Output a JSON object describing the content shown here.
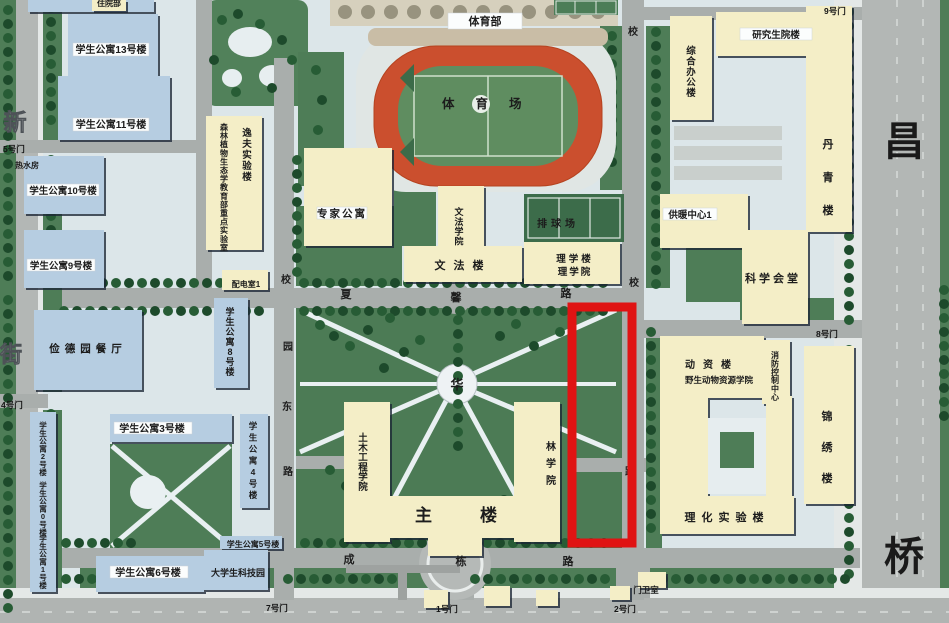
{
  "colors": {
    "highlight": "#e01313",
    "track": "#cb4f2e",
    "field": "#5f8d60",
    "lawn": "#4e7d57",
    "dorm_building": "#b6cde1",
    "academic_building": "#f4eec7",
    "road": "#a9aeac"
  },
  "buildings": {
    "hospital": "住院部",
    "dorm13": "学生公寓13号楼",
    "dorm11": "学生公寓11号楼",
    "dorm10": "学生公寓10号楼",
    "dorm9": "学生公寓9号楼",
    "canteen": "俭德园餐厅",
    "dorm8": "学生公寓8号楼",
    "dorm3": "学生公寓3号楼",
    "dorm4": "学生公寓4号楼",
    "dorm2": "学生公寓2号楼",
    "dorm0": "学生公寓0号楼",
    "dorm1": "学生公寓1号楼",
    "dorm6": "学生公寓6号楼",
    "dorm5": "学生公寓5号楼",
    "techpark": "大学生科技园",
    "hotwater": "热水房",
    "forest_lab": "森林植物生态学教育部重点实验室",
    "yifu": "逸夫实验楼",
    "peidian": "配电室1",
    "expert": "专家公寓",
    "wenfa_college": "文法学院",
    "wenfa_lou": "文法楼",
    "tiyubu": "体育部",
    "stadium": "体育场",
    "volleyball": "排球场",
    "lixuelou": "理学楼",
    "lixueyuan": "理学院",
    "grad": "研究生院楼",
    "zonghe": "综合办公楼",
    "danqing": "丹青楼",
    "gongnuan": "供暖中心1",
    "kexue": "科学会堂",
    "dongzi": "动资楼",
    "yesheng": "野生动物资源学院",
    "xiaofang": "消防控制中心",
    "jinxiu": "锦绣楼",
    "lihua": "理化实验楼",
    "zhulou": "主楼",
    "linxueyuan": "林学院",
    "tumu": "土木工程学院",
    "guard": "门卫室",
    "hua": "华"
  },
  "gates": {
    "g1": "1号门",
    "g2": "2号门",
    "g4": "4号门",
    "g5": "5号门",
    "g7": "7号门",
    "g8": "8号门",
    "g9": "9号门"
  },
  "roads": {
    "ew1": "夏",
    "ew2": "馨",
    "ew3": "路",
    "south1": "成",
    "south2": "栋",
    "south3": "路",
    "inner_e1": "校",
    "inner_e2": "园",
    "inner_e3": "东",
    "inner_e4": "路",
    "east_top": "校",
    "east1": "校",
    "east2": "园",
    "east3": "路",
    "street_left1": "新",
    "street_left2": "街",
    "street_right1": "昌",
    "street_right2": "桥"
  }
}
